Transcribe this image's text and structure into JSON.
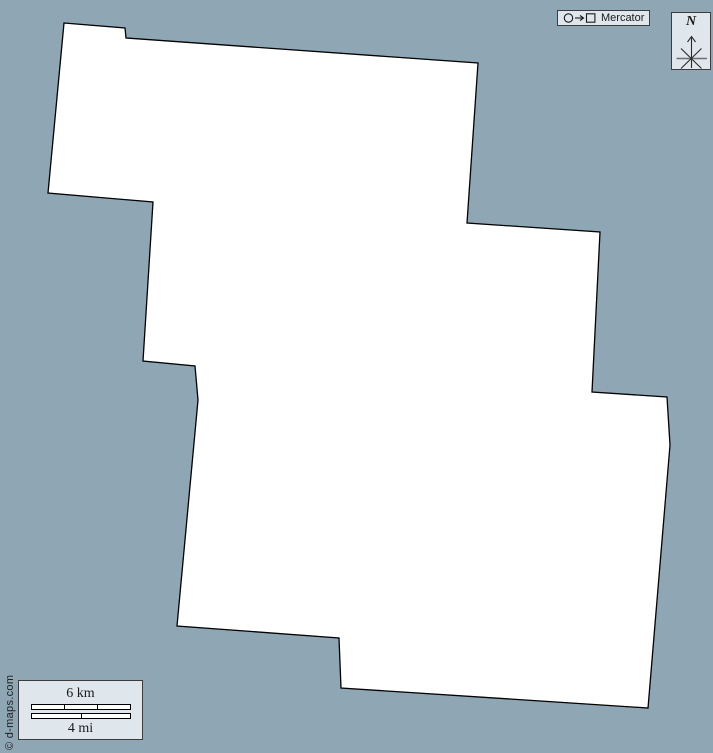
{
  "colors": {
    "background": "#8fa6b5",
    "panel_fill": "#dfe7ec",
    "panel_border": "#3c3c3c",
    "map_fill": "#ffffff",
    "map_stroke": "#000000"
  },
  "map": {
    "projection_label": "Mercator",
    "outline_points": "64,23 125,28 126,38 478,63 467,223 600,232 592,392 667,397 670,445 648,708 341,688 339,638 177,626 198,400 195,366 143,361 153,202 48,193"
  },
  "compass": {
    "north_label": "N"
  },
  "scale_bar": {
    "km_label": "6 km",
    "mi_label": "4 mi",
    "km_divisions": 3,
    "mi_divisions": 2
  },
  "credit": {
    "text": "© d-maps.com"
  }
}
